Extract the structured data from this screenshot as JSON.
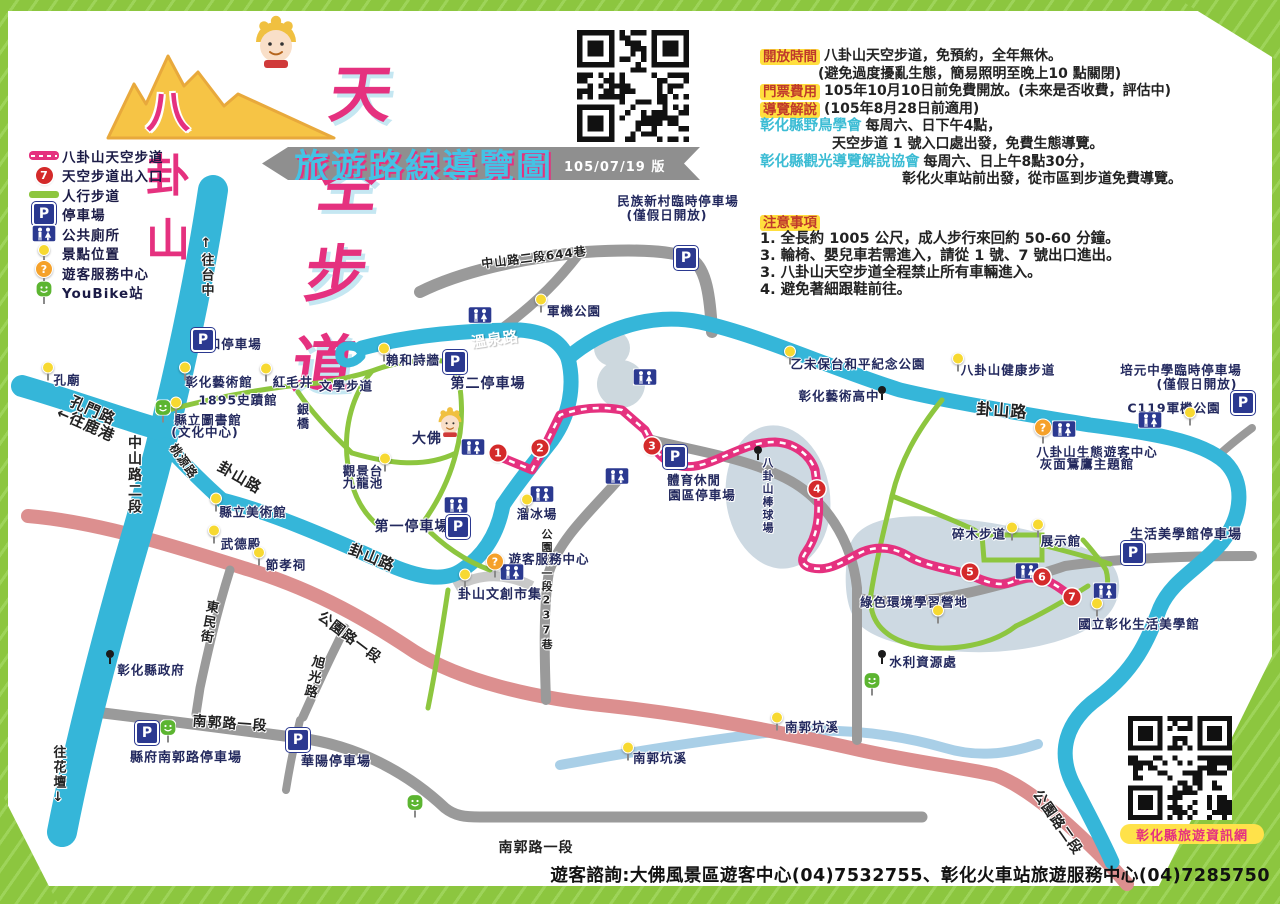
{
  "title": {
    "mountain": "八卦山",
    "main": "天空步道",
    "banner": "旅遊路線導覽圖",
    "version": "105/07/19 版"
  },
  "legend": {
    "items": [
      {
        "icon": "route-swatch",
        "label": "八卦山天空步道"
      },
      {
        "icon": "entrance",
        "digit": "7",
        "label": "天空步道出入口"
      },
      {
        "icon": "path-swatch",
        "label": "人行步道"
      },
      {
        "icon": "parking",
        "label": "停車場"
      },
      {
        "icon": "toilet",
        "label": "公共廁所"
      },
      {
        "icon": "spot",
        "label": "景點位置"
      },
      {
        "icon": "info",
        "label": "遊客服務中心"
      },
      {
        "icon": "youbike",
        "label": "YouBike站"
      }
    ]
  },
  "info": {
    "rows": [
      {
        "badge": "開放時間",
        "text": "八卦山天空步道，免預約，全年無休。"
      },
      {
        "indent": 58,
        "text": "(避免過度擾亂生態，簡易照明至晚上10 點關閉)"
      },
      {
        "badge": "門票費用",
        "text": "105年10月10日前免費開放。(未來是否收費，評估中)"
      },
      {
        "badge": "導覽解說",
        "text": "(105年8月28日前適用)"
      },
      {
        "org": "彰化縣野鳥學會",
        "text": "每周六、日下午4點，"
      },
      {
        "indent": 72,
        "text": "天空步道 1 號入口處出發，免費生態導覽。"
      },
      {
        "org": "彰化縣觀光導覽解說協會",
        "text": "每周六、日上午8點30分，"
      },
      {
        "indent": 142,
        "text": "彰化火車站前出發，從市區到步道免費導覽。"
      }
    ]
  },
  "notes": {
    "heading": "注意事項",
    "items": [
      "1. 全長約 1005 公尺，成人步行來回約 50-60 分鐘。",
      "3. 輪椅、嬰兒車若需進入，請從 1 號、7 號出口進出。",
      "3. 八卦山天空步道全程禁止所有車輛進入。",
      "4. 避免著細跟鞋前往。"
    ]
  },
  "footer": {
    "text": "遊客諮詢:大佛風景區遊客中心(04)7532755、彰化火車站旅遊服務中心(04)7285750"
  },
  "qr_bottom_label": "彰化縣旅遊資訊網",
  "colors": {
    "route_pink": "#e5317f",
    "road_cyan": "#35b6d9",
    "path_green": "#8dc63f",
    "road_gray": "#9a9a9a",
    "road_salmon": "#dc8f8f",
    "stream_blue": "#a9cfe7",
    "parking_blue": "#2b3990",
    "entrance_red": "#d42a2a",
    "spot_yellow": "#f7d931",
    "info_orange": "#f5a12a",
    "youbike_green": "#5cb531",
    "frame_green": "#8cc63f",
    "badge_yellow": "#ffdf3e",
    "badge_text": "#c0392b",
    "org_cyan": "#3bbcd4"
  },
  "map": {
    "road_labels": [
      {
        "t": "溫泉路",
        "x": 495,
        "y": 339,
        "r": -8,
        "c": "white",
        "s": 15
      },
      {
        "t": "孔門路",
        "x": 93,
        "y": 410,
        "r": 24,
        "s": 15
      },
      {
        "t": "中山路二段",
        "x": 134,
        "y": 475,
        "v": 1,
        "s": 14
      },
      {
        "t": "卦山路",
        "x": 240,
        "y": 477,
        "r": 30,
        "s": 15
      },
      {
        "t": "卦山路",
        "x": 372,
        "y": 557,
        "r": 22,
        "s": 15
      },
      {
        "t": "卦山路",
        "x": 1002,
        "y": 409,
        "r": 4,
        "s": 16
      },
      {
        "t": "桃源路",
        "x": 184,
        "y": 461,
        "r": 55,
        "s": 12
      },
      {
        "t": "公園路一段237巷",
        "x": 546,
        "y": 590,
        "v": 1,
        "s": 11
      },
      {
        "t": "公園路一段",
        "x": 350,
        "y": 637,
        "r": 37,
        "s": 14
      },
      {
        "t": "公園路二段",
        "x": 1058,
        "y": 822,
        "r": 55,
        "s": 14
      },
      {
        "t": "南郭路一段",
        "x": 230,
        "y": 723,
        "r": 4,
        "s": 14
      },
      {
        "t": "南郭路一段",
        "x": 536,
        "y": 847,
        "s": 14
      },
      {
        "t": "東民街",
        "x": 208,
        "y": 622,
        "v": 1,
        "r": 10,
        "s": 13
      },
      {
        "t": "旭光路",
        "x": 313,
        "y": 677,
        "v": 1,
        "r": 14,
        "s": 13
      },
      {
        "t": "中山路二段644巷",
        "x": 534,
        "y": 257,
        "r": -7,
        "s": 12
      },
      {
        "t": "↑往台中",
        "x": 206,
        "y": 267,
        "v": 1,
        "s": 13
      },
      {
        "t": "往花壇↓",
        "x": 58,
        "y": 776,
        "v": 1,
        "s": 13
      },
      {
        "t": "←往鹿港",
        "x": 86,
        "y": 424,
        "r": 24,
        "s": 15
      }
    ],
    "place_labels": [
      {
        "t": "利和停車場",
        "x": 228,
        "y": 343
      },
      {
        "t": "孔廟",
        "x": 67,
        "y": 379
      },
      {
        "t": "彰化藝術館",
        "x": 219,
        "y": 381
      },
      {
        "t": "紅毛井",
        "x": 293,
        "y": 381
      },
      {
        "t": "1895史蹟館",
        "x": 238,
        "y": 399
      },
      {
        "t": "縣立圖書館",
        "x": 208,
        "y": 419
      },
      {
        "t": "(文化中心)",
        "x": 205,
        "y": 431
      },
      {
        "t": "文學步道",
        "x": 346,
        "y": 385
      },
      {
        "t": "銀橋",
        "x": 303,
        "y": 417,
        "v": 1,
        "s": 12
      },
      {
        "t": "賴和詩牆",
        "x": 413,
        "y": 359
      },
      {
        "t": "第二停車場",
        "x": 488,
        "y": 383,
        "s": 14
      },
      {
        "t": "軍機公園",
        "x": 574,
        "y": 310
      },
      {
        "t": "民族新村臨時停車場",
        "x": 678,
        "y": 200
      },
      {
        "t": "(僅假日開放)",
        "x": 667,
        "y": 214
      },
      {
        "t": "乙未保台和平紀念公園",
        "x": 858,
        "y": 363
      },
      {
        "t": "彰化藝術高中",
        "x": 839,
        "y": 395
      },
      {
        "t": "八卦山健康步道",
        "x": 1008,
        "y": 369
      },
      {
        "t": "培元中學臨時停車場",
        "x": 1181,
        "y": 369
      },
      {
        "t": "(僅假日開放)",
        "x": 1197,
        "y": 383
      },
      {
        "t": "C119軍機公園",
        "x": 1174,
        "y": 407
      },
      {
        "t": "八卦山生態遊客中心",
        "x": 1097,
        "y": 451
      },
      {
        "t": "灰面鵟鷹主題館",
        "x": 1087,
        "y": 463
      },
      {
        "t": "大佛",
        "x": 427,
        "y": 438,
        "s": 14
      },
      {
        "t": "觀景台",
        "x": 363,
        "y": 470
      },
      {
        "t": "九龍池",
        "x": 363,
        "y": 482
      },
      {
        "t": "第一停車場",
        "x": 412,
        "y": 526,
        "s": 14
      },
      {
        "t": "遊客服務中心",
        "x": 549,
        "y": 558
      },
      {
        "t": "卦山文創市集",
        "x": 500,
        "y": 593,
        "s": 13
      },
      {
        "t": "溜冰場",
        "x": 537,
        "y": 513
      },
      {
        "t": "體育休閒",
        "x": 694,
        "y": 479
      },
      {
        "t": "園區停車場",
        "x": 702,
        "y": 494
      },
      {
        "t": "八卦山棒球場",
        "x": 767,
        "y": 496,
        "v": 1,
        "s": 11
      },
      {
        "t": "碎木步道",
        "x": 979,
        "y": 533
      },
      {
        "t": "展示館",
        "x": 1061,
        "y": 540
      },
      {
        "t": "生活美學館停車場",
        "x": 1186,
        "y": 533,
        "s": 13
      },
      {
        "t": "國立彰化生活美學館",
        "x": 1139,
        "y": 623
      },
      {
        "t": "綠色環境學習營地",
        "x": 914,
        "y": 601
      },
      {
        "t": "水利資源處",
        "x": 923,
        "y": 661
      },
      {
        "t": "南郭坑溪",
        "x": 812,
        "y": 726
      },
      {
        "t": "南郭坑溪",
        "x": 660,
        "y": 757
      },
      {
        "t": "彰化縣政府",
        "x": 151,
        "y": 669
      },
      {
        "t": "縣府南郭路停車場",
        "x": 186,
        "y": 756,
        "s": 13
      },
      {
        "t": "華陽停車場",
        "x": 336,
        "y": 760,
        "s": 13
      },
      {
        "t": "縣立美術館",
        "x": 253,
        "y": 511
      },
      {
        "t": "武德殿",
        "x": 241,
        "y": 543
      },
      {
        "t": "節孝祠",
        "x": 286,
        "y": 564
      }
    ],
    "entrances": [
      {
        "n": "1",
        "x": 498,
        "y": 453
      },
      {
        "n": "2",
        "x": 540,
        "y": 448
      },
      {
        "n": "3",
        "x": 652,
        "y": 446
      },
      {
        "n": "4",
        "x": 817,
        "y": 489
      },
      {
        "n": "5",
        "x": 970,
        "y": 572
      },
      {
        "n": "6",
        "x": 1042,
        "y": 577
      },
      {
        "n": "7",
        "x": 1072,
        "y": 597
      }
    ],
    "parking": [
      [
        203,
        340
      ],
      [
        455,
        362
      ],
      [
        458,
        527
      ],
      [
        686,
        258
      ],
      [
        675,
        457
      ],
      [
        1133,
        553
      ],
      [
        1243,
        403
      ],
      [
        147,
        733
      ],
      [
        298,
        740
      ]
    ],
    "toilets": [
      [
        480,
        315
      ],
      [
        645,
        377
      ],
      [
        473,
        447
      ],
      [
        456,
        505
      ],
      [
        542,
        494
      ],
      [
        617,
        476
      ],
      [
        512,
        572
      ],
      [
        1027,
        571
      ],
      [
        1105,
        591
      ],
      [
        1064,
        429
      ],
      [
        1150,
        420
      ]
    ],
    "spots": [
      [
        48,
        371
      ],
      [
        185,
        371
      ],
      [
        266,
        372
      ],
      [
        176,
        406
      ],
      [
        384,
        352
      ],
      [
        541,
        303
      ],
      [
        790,
        355
      ],
      [
        958,
        362
      ],
      [
        1190,
        416
      ],
      [
        385,
        462
      ],
      [
        465,
        578
      ],
      [
        527,
        503
      ],
      [
        1012,
        531
      ],
      [
        1038,
        528
      ],
      [
        1097,
        607
      ],
      [
        938,
        614
      ],
      [
        777,
        721
      ],
      [
        628,
        751
      ],
      [
        216,
        502
      ],
      [
        214,
        534
      ],
      [
        259,
        556
      ]
    ],
    "landmarks": [
      [
        110,
        657
      ],
      [
        882,
        393
      ],
      [
        758,
        453
      ],
      [
        882,
        657
      ]
    ],
    "youbike": [
      [
        163,
        411
      ],
      [
        168,
        731
      ],
      [
        415,
        806
      ],
      [
        872,
        684
      ]
    ],
    "info_points": [
      [
        495,
        565
      ],
      [
        1043,
        431
      ]
    ],
    "buddha_statue": {
      "x": 450,
      "y": 423
    }
  }
}
